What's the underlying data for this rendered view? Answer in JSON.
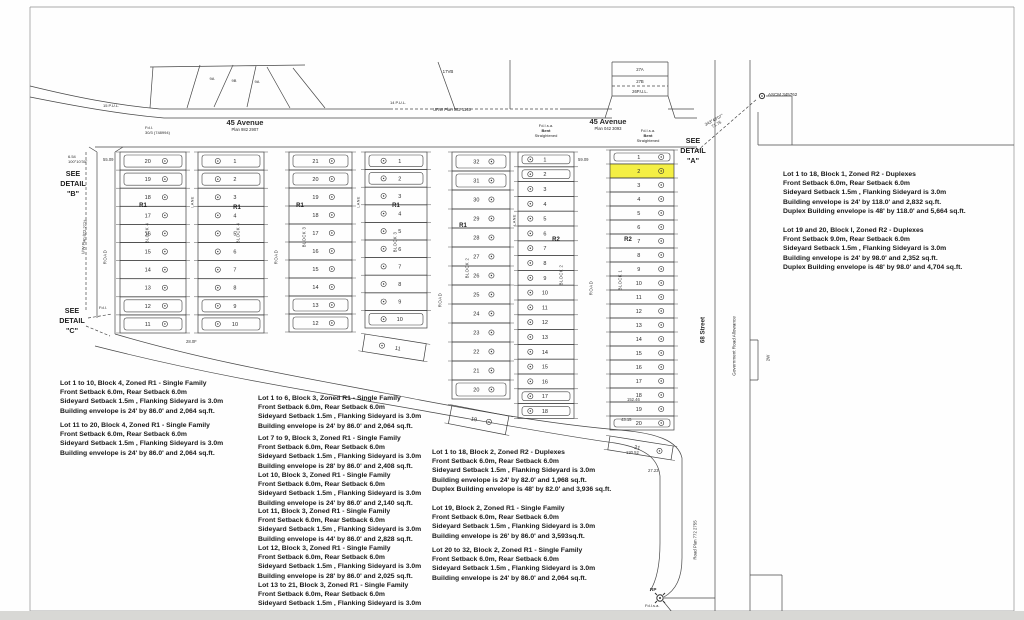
{
  "colors": {
    "ink": "#3f3f3f",
    "highlight": "#f4ef44",
    "paper": "#fefefe"
  },
  "streets": {
    "avenue45_west": {
      "name": "45 Avenue",
      "plan": "Plan 982 2907"
    },
    "avenue45_east": {
      "name": "45 Avenue",
      "plan": "Plan 042 3093"
    },
    "street_68": "68 Street",
    "gov_road_allowance": "Government Road Allowance",
    "road_plan": "Road Plan 772 2755",
    "strip_label": "2W",
    "urw_plan": "URW Plan 982 1145",
    "uw_plan": "U/W Plan 872 2773",
    "pul_15": "15 P.U.L.",
    "pul_14": "14 P.U.L."
  },
  "road_label": "ROAD",
  "details": {
    "a": [
      "SEE",
      "DETAIL",
      "\"A\""
    ],
    "b": [
      "SEE",
      "DETAIL",
      "\"B\""
    ],
    "c": [
      "SEE",
      "DETAIL",
      "\"C\""
    ]
  },
  "parcels": {
    "fan": [
      "9A",
      "9B",
      "9A"
    ],
    "v17": "17VB",
    "p27a": "27A",
    "p27b": "27B",
    "p26": "26P.U.L."
  },
  "monuments": {
    "ascm": "ASCM 345762",
    "bearing": "343°48'07\"",
    "bearing_dist": "71.75",
    "bent1": [
      "Fd.I.s.a.",
      "Bent",
      "Straightened"
    ],
    "bent2": [
      "Fd.I.s.a.",
      "Bent",
      "Straightened"
    ],
    "rp": "RP",
    "rp_sub": "Fd.I.s.a.",
    "fdl": "Fd.I.",
    "fdtop": [
      "Fd.I.",
      "30/3 (748994)"
    ],
    "corner": [
      "6.54",
      "100°10'30\""
    ]
  },
  "dims": [
    "55.09",
    "59.09",
    "152.46",
    "43.15",
    "130.52",
    "27.23",
    "28.0F"
  ],
  "highlight": {
    "block": "BLOCK 1",
    "lot": "2"
  },
  "blocks": [
    {
      "label": "BLOCK 4",
      "lane": "LANE",
      "columns": [
        {
          "zone": "R1",
          "lots": [
            "20",
            "19",
            "18",
            "17",
            "16",
            "15",
            "14",
            "13",
            "12",
            "11"
          ]
        },
        {
          "zone": "R1",
          "lots": [
            "1",
            "2",
            "3",
            "4",
            "5",
            "6",
            "7",
            "8",
            "9",
            "10"
          ]
        }
      ]
    },
    {
      "label": "BLOCK 3",
      "lane": "LANE",
      "columns": [
        {
          "zone": "R1",
          "lots": [
            "21",
            "20",
            "19",
            "18",
            "17",
            "16",
            "15",
            "14",
            "13",
            "12"
          ]
        },
        {
          "zone": "R1",
          "lots": [
            "1",
            "2",
            "3",
            "4",
            "5",
            "6",
            "7",
            "8",
            "9",
            "10",
            "11"
          ]
        }
      ]
    },
    {
      "label": "BLOCK 2",
      "lane": "LANE",
      "columns": [
        {
          "zone": "R1",
          "lots": [
            "32",
            "31",
            "30",
            "29",
            "28",
            "27",
            "26",
            "25",
            "24",
            "23",
            "22",
            "21",
            "20",
            "19"
          ]
        },
        {
          "zone": "R2",
          "lots": [
            "1",
            "2",
            "3",
            "4",
            "5",
            "6",
            "7",
            "8",
            "9",
            "10",
            "11",
            "12",
            "13",
            "14",
            "15",
            "16",
            "17",
            "18"
          ]
        }
      ]
    },
    {
      "label": "BLOCK 1",
      "columns": [
        {
          "zone": "R2",
          "lots": [
            "1",
            "2",
            "3",
            "4",
            "5",
            "6",
            "7",
            "8",
            "9",
            "10",
            "11",
            "12",
            "13",
            "14",
            "15",
            "16",
            "17",
            "18",
            "19",
            "20",
            "21"
          ]
        }
      ]
    }
  ],
  "notes": [
    {
      "lines": [
        "Lot 1 to 10, Block 4, Zoned R1 - Single Family",
        "Front Setback 6.0m, Rear Setback 6.0m",
        "Sideyard Setback 1.5m , Flanking Sideyard is 3.0m",
        "Building envelope is 24' by 86.0'  and 2,064 sq.ft."
      ]
    },
    {
      "lines": [
        "Lot 11 to 20, Block 4, Zoned R1 - Single Family",
        "Front Setback 6.0m, Rear Setback 6.0m",
        "Sideyard Setback 1.5m , Flanking Sideyard is 3.0m",
        "Building envelope is 24' by 86.0'  and 2,064 sq.ft."
      ]
    },
    {
      "lines": [
        "Lot 1 to 6, Block 3, Zoned R1 - Single Family",
        "Front Setback 6.0m, Rear Setback 6.0m",
        "Sideyard Setback 1.5m , Flanking Sideyard is 3.0m",
        "Building envelope is 24' by 86.0'  and 2,064 sq.ft."
      ]
    },
    {
      "lines": [
        "Lot 7 to 9, Block 3, Zoned R1 - Single Family",
        "Front Setback 6.0m, Rear Setback 6.0m",
        "Sideyard Setback 1.5m , Flanking Sideyard is 3.0m",
        "Building envelope is 28' by 86.0'  and 2,408 sq.ft."
      ]
    },
    {
      "lines": [
        "Lot 10, Block 3, Zoned R1 - Single Family",
        "Front Setback 6.0m, Rear Setback 6.0m",
        "Sideyard Setback 1.5m , Flanking Sideyard is 3.0m",
        "Building envelope is 24' by 86.0'  and 2,140 sq.ft."
      ]
    },
    {
      "lines": [
        "Lot 11, Block 3, Zoned R1 - Single Family",
        "Front Setback 6.0m, Rear Setback 6.0m",
        "Sideyard Setback 1.5m , Flanking Sideyard is 3.0m",
        "Building envelope is 44' by 86.0'  and 2,828 sq.ft."
      ]
    },
    {
      "lines": [
        "Lot 12, Block 3, Zoned R1 - Single Family",
        "Front Setback 6.0m, Rear Setback 6.0m",
        "Sideyard Setback 1.5m , Flanking Sideyard is 3.0m",
        "Building envelope is 28' by 86.0'  and 2,025 sq.ft."
      ]
    },
    {
      "lines": [
        "Lot 13 to 21, Block 3, Zoned R1 - Single Family",
        "Front Setback 6.0m, Rear Setback 6.0m",
        "Sideyard Setback 1.5m , Flanking Sideyard is 3.0m"
      ]
    },
    {
      "lines": [
        "Lot 1 to 18, Block 2, Zoned R2 - Duplexes",
        "Front Setback 6.0m, Rear Setback 6.0m",
        "Sideyard Setback 1.5m , Flanking Sideyard is 3.0m",
        "Building envelope is 24' by 82.0'  and 1,968 sq.ft.",
        "Duplex Building envelope is 48' by 82.0'  and 3,936 sq.ft."
      ]
    },
    {
      "lines": [
        "Lot 19, Block 2, Zoned R1 - Single Family",
        "Front Setback 6.0m, Rear Setback 6.0m",
        "Sideyard Setback 1.5m , Flanking Sideyard is 3.0m",
        "Building envelope is 26' by 86.0'  and 3,593sq.ft."
      ]
    },
    {
      "lines": [
        "Lot 20 to 32, Block 2, Zoned R1 - Single Family",
        "Front Setback 6.0m, Rear Setback 6.0m",
        "Sideyard Setback 1.5m , Flanking Sideyard is 3.0m",
        "Building envelope is 24' by 86.0'  and 2,064 sq.ft."
      ]
    },
    {
      "lines": [
        "Lot 1 to 18, Block 1, Zoned R2 - Duplexes",
        "Front Setback 6.0m, Rear Setback 6.0m",
        "Sideyard Setback 1.5m , Flanking Sideyard is 3.0m",
        "Building envelope is 24' by 118.0'  and 2,832 sq.ft.",
        "Duplex Building envelope is 48' by 118.0'  and 5,664 sq.ft."
      ]
    },
    {
      "lines": [
        "Lot 19 and 20, Block I, Zoned R2 - Duplexes",
        "Front Setback 9.0m, Rear Setback 6.0m",
        "Sideyard Setback 1.5m , Flanking Sideyard is 3.0m",
        "Building envelope is 24' by 98.0'  and 2,352 sq.ft.",
        "Duplex Building envelope is 48' by 98.0'  and 4,704 sq.ft."
      ]
    }
  ]
}
